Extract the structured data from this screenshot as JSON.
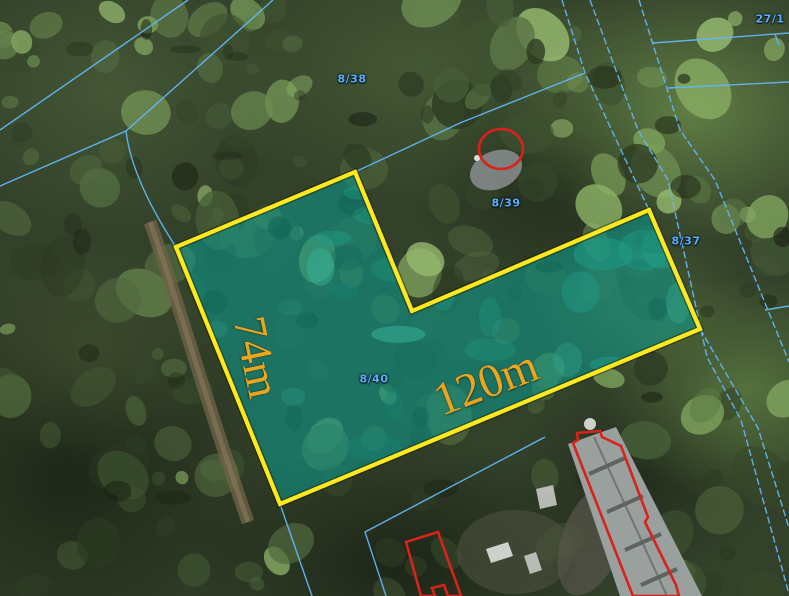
{
  "map": {
    "description": "aerial cadastral map with highlighted parcel",
    "parcel_labels": [
      {
        "id": "8-38",
        "text": "8/38"
      },
      {
        "id": "8-39",
        "text": "8/39"
      },
      {
        "id": "8-40",
        "text": "8/40"
      },
      {
        "id": "8-37",
        "text": "8/37"
      },
      {
        "id": "27-1",
        "text": "27/1"
      }
    ],
    "dimension_labels": {
      "left_edge": "74m",
      "bottom_edge": "120m"
    },
    "highlighted_parcel": {
      "number": "8/40",
      "width_label": "74m",
      "length_label": "120m"
    },
    "colors": {
      "parcel_fill": "#0AA296",
      "parcel_stroke": "#FFE81C",
      "cadastral_line": "#62B6F5",
      "dimension_text": "#E9A61E",
      "parcel_number_text": "#5FB0F2",
      "marker_red": "#D9221C"
    }
  }
}
